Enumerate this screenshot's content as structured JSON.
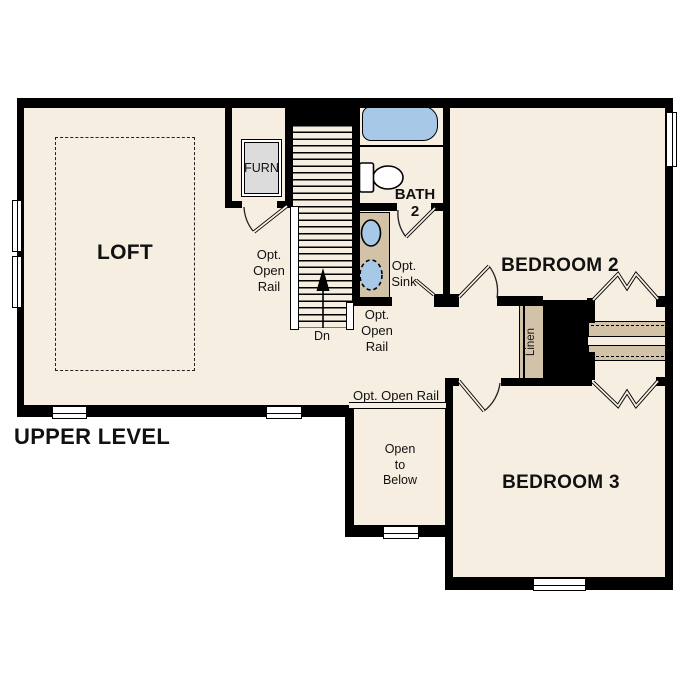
{
  "plan": {
    "title": "UPPER LEVEL",
    "rooms": {
      "loft": "LOFT",
      "bedroom2": "BEDROOM 2",
      "bedroom3": "BEDROOM 3",
      "bath_line1": "BATH",
      "bath_line2": "2",
      "furnace": "FURN",
      "linen": "Linen"
    },
    "labels": {
      "stairs_down": "Dn",
      "open_rail_stairs": [
        "Opt.",
        "Open",
        "Rail"
      ],
      "open_rail_hall": [
        "Opt.",
        "Open",
        "Rail"
      ],
      "open_rail_loft": "Opt. Open Rail",
      "opt_sink": [
        "Opt.",
        "Sink"
      ],
      "open_to_below": [
        "Open",
        "to",
        "Below"
      ]
    },
    "colors": {
      "floor": "#f6eee1",
      "wall": "#000000",
      "casework_tan": "#d2c3a8",
      "plumbing_blue": "#a8c8e8",
      "furnace_gray": "#dcdcdc",
      "background": "#ffffff"
    }
  }
}
